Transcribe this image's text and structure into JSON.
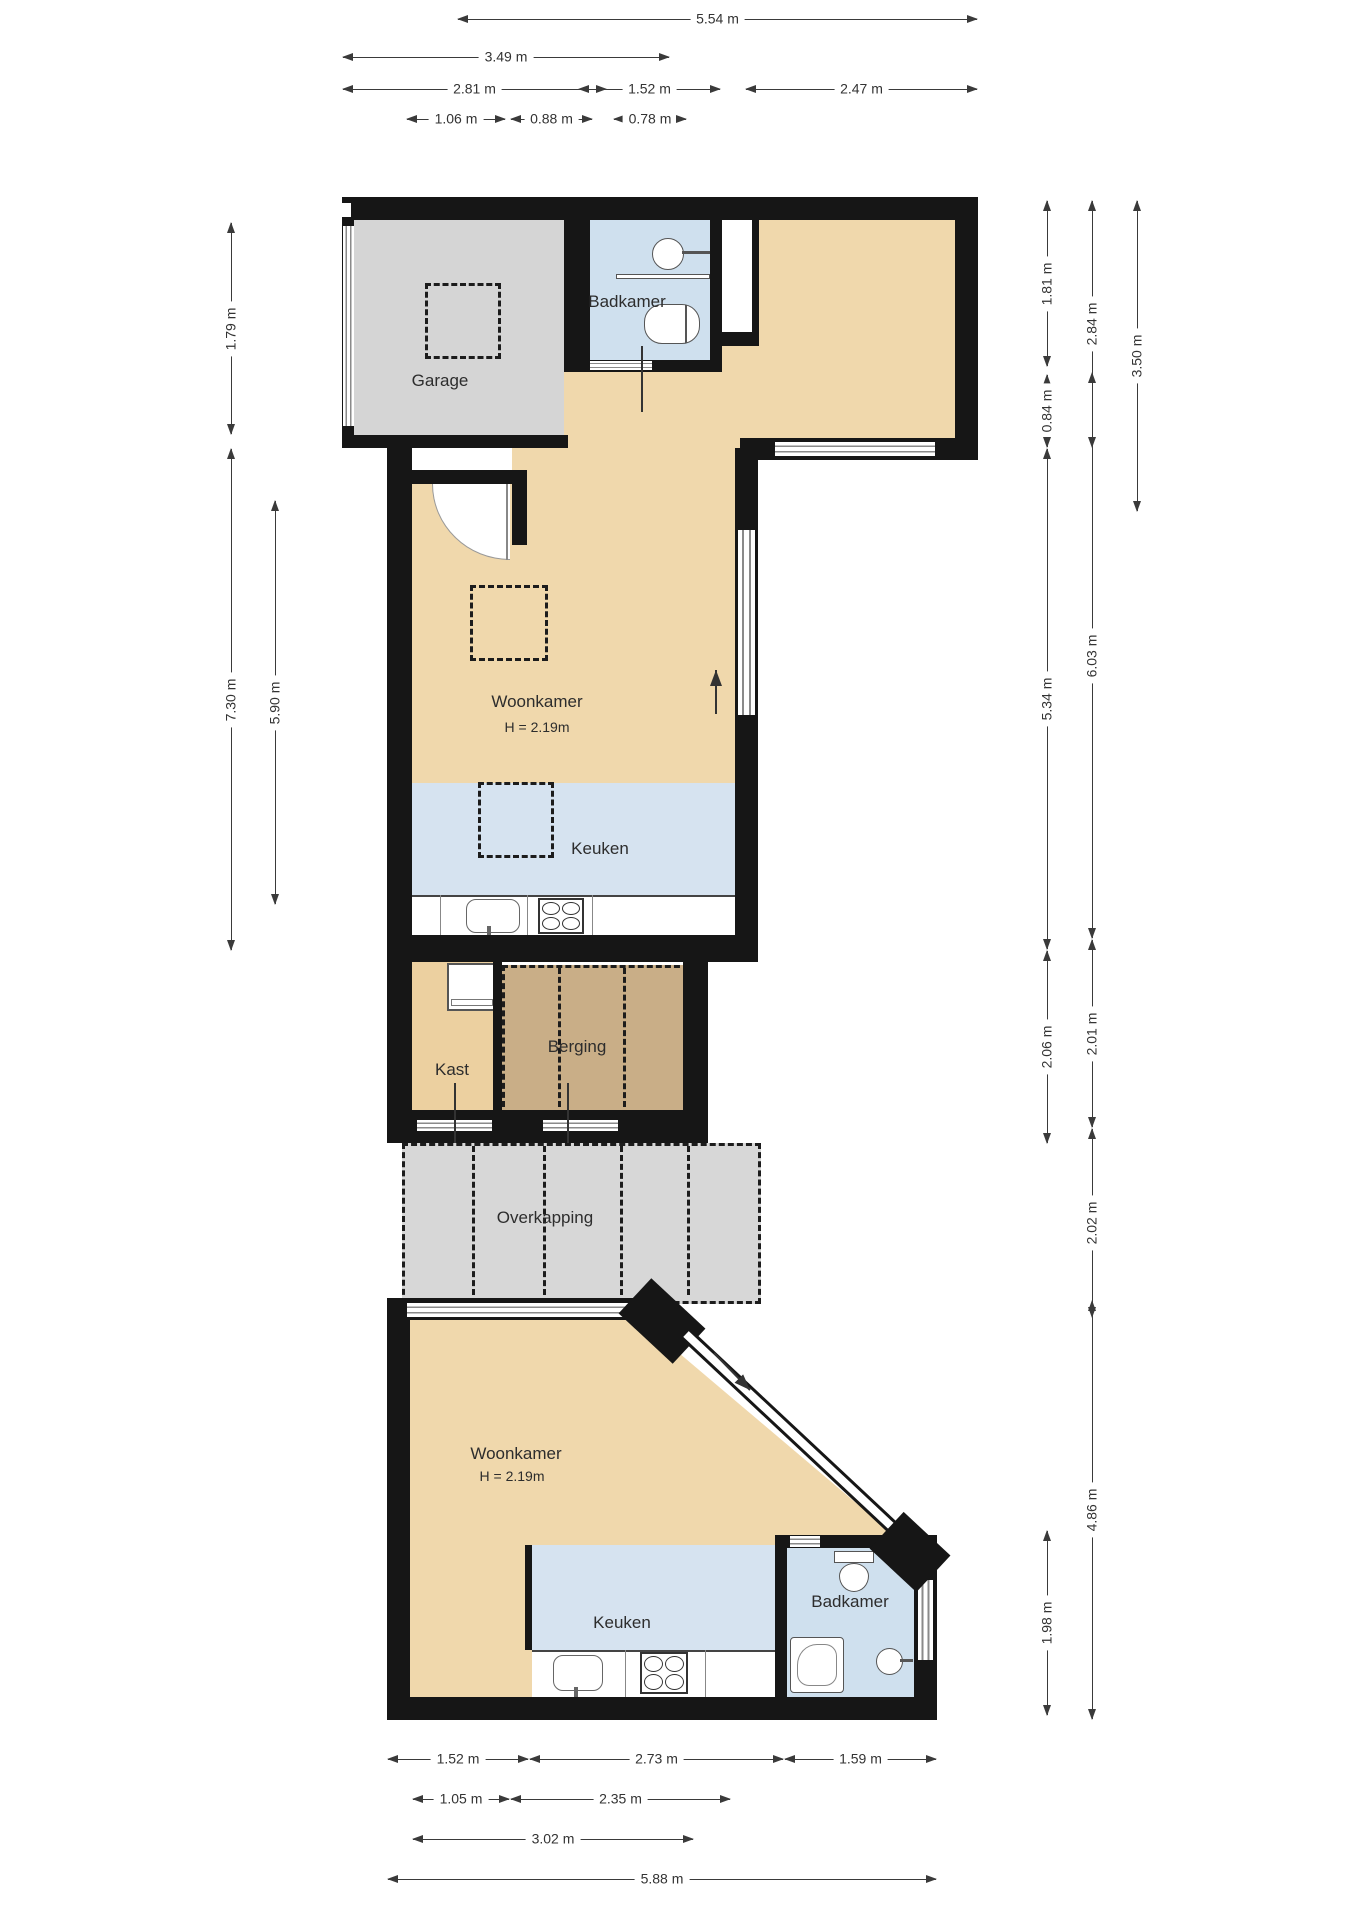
{
  "plan_type": "floor-plan",
  "rooms": {
    "garage": {
      "label": "Garage"
    },
    "badkamer_boven": {
      "label": "Badkamer"
    },
    "woonkamer_midden": {
      "label": "Woonkamer",
      "height_note": "H = 2.19m"
    },
    "keuken_midden": {
      "label": "Keuken"
    },
    "kast": {
      "label": "Kast"
    },
    "berging": {
      "label": "Berging"
    },
    "overkapping": {
      "label": "Overkapping"
    },
    "woonkamer_beneden": {
      "label": "Woonkamer",
      "height_note": "H = 2.19m"
    },
    "keuken_beneden": {
      "label": "Keuken"
    },
    "badkamer_beneden": {
      "label": "Badkamer"
    }
  },
  "dimensions": {
    "top": [
      {
        "label": "5.54 m"
      },
      {
        "label": "3.49 m"
      },
      {
        "label": "2.81 m"
      },
      {
        "label": "1.52 m"
      },
      {
        "label": "2.47 m"
      },
      {
        "label": "1.06 m"
      },
      {
        "label": "0.88 m"
      },
      {
        "label": "0.78 m"
      }
    ],
    "left": [
      {
        "label": "1.79 m"
      },
      {
        "label": "7.30 m"
      },
      {
        "label": "5.90 m"
      }
    ],
    "right": [
      {
        "label": "1.81 m"
      },
      {
        "label": "0.84 m"
      },
      {
        "label": "2.84 m"
      },
      {
        "label": "3.50 m"
      },
      {
        "label": "5.34 m"
      },
      {
        "label": "6.03 m"
      },
      {
        "label": "2.06 m"
      },
      {
        "label": "2.01 m"
      },
      {
        "label": "2.02 m"
      },
      {
        "label": "4.86 m"
      },
      {
        "label": "1.98 m"
      }
    ],
    "bottom": [
      {
        "label": "1.52 m"
      },
      {
        "label": "2.73 m"
      },
      {
        "label": "1.59 m"
      },
      {
        "label": "1.05 m"
      },
      {
        "label": "2.35 m"
      },
      {
        "label": "3.02 m"
      },
      {
        "label": "5.88 m"
      }
    ]
  },
  "colors": {
    "wall": "#161616",
    "living_floor": "#f0d8ac",
    "garage_floor": "#d5d5d5",
    "bathroom_floor": "#cfe0ee",
    "kitchen_floor": "#d6e3f0",
    "storage_floor": "#c9ae87",
    "closet_floor": "#ecd0a0",
    "canopy_floor": "#d7d7d7",
    "dimension_text": "#333333"
  },
  "fixtures": [
    "sink",
    "toilet",
    "shelf",
    "stove",
    "kitchen-sink",
    "washing-machine",
    "shower",
    "skylight",
    "door-swing",
    "window",
    "sliding-door",
    "entry-arrow"
  ]
}
